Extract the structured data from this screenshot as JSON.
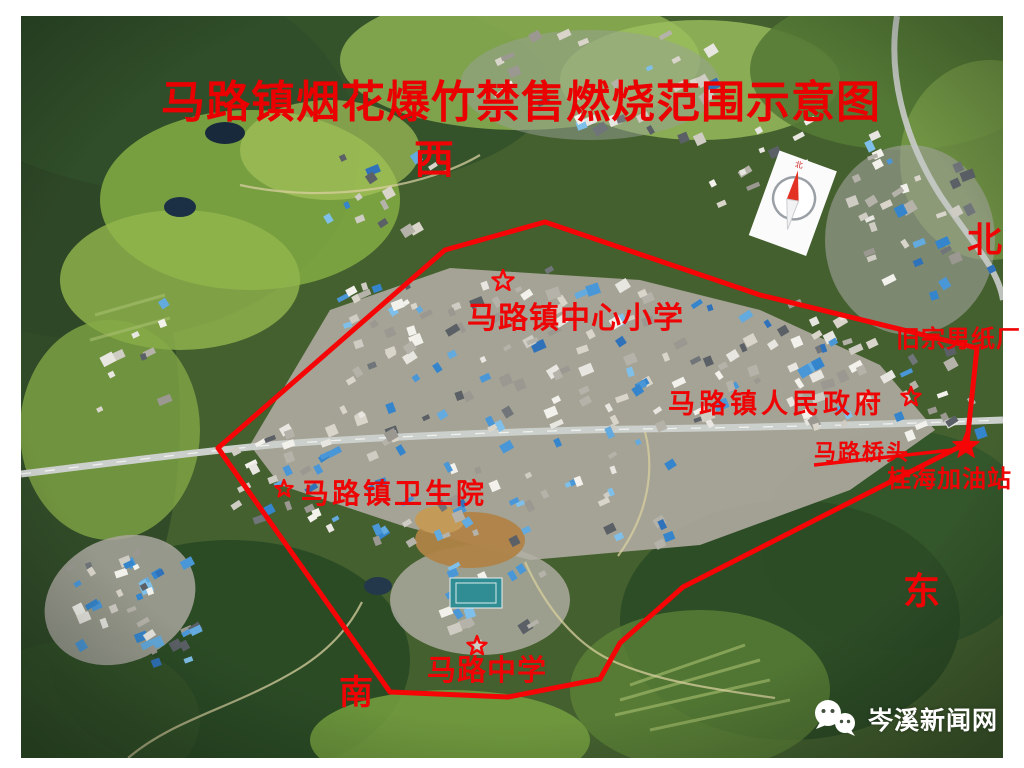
{
  "title": "马路镇烟花爆竹禁售燃烧范围示意图",
  "directions": {
    "west": "西",
    "north": "北",
    "east": "东",
    "south": "南"
  },
  "landmarks": {
    "primary_school": "马路镇中心小学",
    "government": "马路镇人民政府",
    "paper_factory": "旧宗男纸厂",
    "bridge": "马路桥头",
    "gas_station": "桂海加油站",
    "health_center": "马路镇卫生院",
    "middle_school": "马路中学"
  },
  "compass": {
    "icon": "compass-north-icon",
    "label": "北"
  },
  "watermark": {
    "icon": "wechat-icon",
    "text": "岑溪新闻网"
  },
  "colors": {
    "annotation_red": "#ee0404",
    "boundary_red": "#f50505",
    "watermark_white": "#ffffff"
  },
  "boundary": {
    "stroke_width": 5,
    "points": [
      [
        218,
        448
      ],
      [
        445,
        250
      ],
      [
        545,
        222
      ],
      [
        760,
        295
      ],
      [
        977,
        348
      ],
      [
        967,
        443
      ],
      [
        683,
        587
      ],
      [
        620,
        643
      ],
      [
        600,
        679
      ],
      [
        508,
        697
      ],
      [
        390,
        692
      ]
    ]
  },
  "bridge_pointer": {
    "from": [
      814,
      465
    ],
    "to": [
      952,
      450
    ]
  },
  "markers": [
    {
      "name": "primary-school-star",
      "x": 503,
      "y": 281,
      "style": "outline",
      "size": 11
    },
    {
      "name": "government-star",
      "x": 911,
      "y": 397,
      "style": "outline",
      "size": 10
    },
    {
      "name": "bridge-star",
      "x": 966,
      "y": 446,
      "style": "solid",
      "size": 14
    },
    {
      "name": "health-center-star",
      "x": 284,
      "y": 489,
      "style": "outline",
      "size": 9
    },
    {
      "name": "middle-school-star",
      "x": 477,
      "y": 646,
      "style": "outline",
      "size": 10
    }
  ]
}
